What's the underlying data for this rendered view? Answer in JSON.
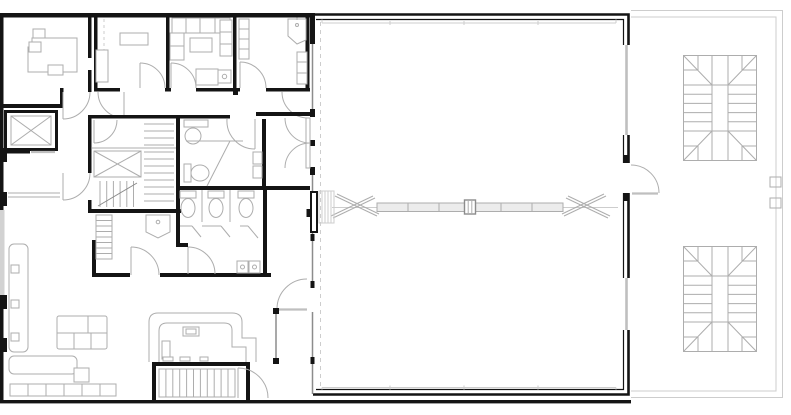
{
  "meta": {
    "drawing_type": "architectural-floor-plan",
    "canvas_width": 791,
    "canvas_height": 415,
    "visible_text": ""
  },
  "colors": {
    "background": "#ffffff",
    "wall": "#141414",
    "wall_medium": "#8c8c8c",
    "line_light": "#adadad",
    "line_faint": "#cdcdcd",
    "glass": "#bfbfbf",
    "fill_light": "#ececec"
  },
  "plan": {
    "spaces": [
      "office",
      "bedroom",
      "living-room",
      "upper-bathroom",
      "corridor",
      "stair-core",
      "bathroom",
      "wc",
      "lounge",
      "hall",
      "terrace"
    ],
    "elements": [
      "elevator-shaft",
      "core-elevator",
      "core-stairs",
      "double-swing-doors",
      "roof-truss",
      "entry-staircase",
      "u-return-stair-north",
      "u-return-stair-south",
      "wall-bench",
      "table-group",
      "cafe-counter",
      "toilet-stalls",
      "wash-basins",
      "corner-sink",
      "bathtub",
      "glazing-band",
      "axis-dashed-line"
    ]
  }
}
